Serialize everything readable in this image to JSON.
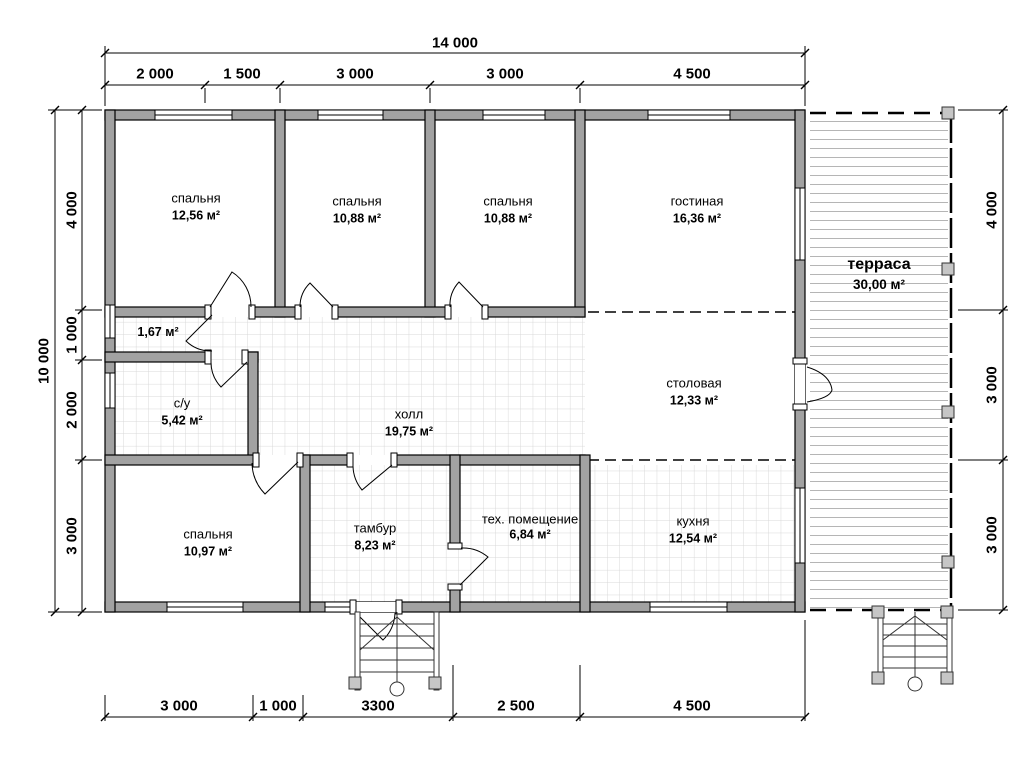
{
  "title": "План дома 14000 x 10000",
  "rooms": [
    {
      "name": "спальня",
      "area": "12,56 м²"
    },
    {
      "name": "спальня",
      "area": "10,88 м²"
    },
    {
      "name": "спальня",
      "area": "10,88 м²"
    },
    {
      "name": "гостиная",
      "area": "16,36 м²"
    },
    {
      "name": "терраса",
      "area": "30,00 м²"
    },
    {
      "name": "",
      "area": "1,67 м²"
    },
    {
      "name": "с/у",
      "area": "5,42 м²"
    },
    {
      "name": "холл",
      "area": "19,75 м²"
    },
    {
      "name": "столовая",
      "area": "12,33 м²"
    },
    {
      "name": "спальня",
      "area": "10,97 м²"
    },
    {
      "name": "тамбур",
      "area": "8,23 м²"
    },
    {
      "name": "тех. помещение",
      "area": "6,84 м²"
    },
    {
      "name": "кухня",
      "area": "12,54 м²"
    }
  ],
  "dimensions": {
    "top_total": "14 000",
    "top": [
      "2 000",
      "1 500",
      "3 000",
      "3 000",
      "4 500"
    ],
    "left_total": "10 000",
    "left": [
      "4 000",
      "1 000",
      "2 000",
      "3 000"
    ],
    "right": [
      "4 000",
      "3 000",
      "3 000"
    ],
    "bottom": [
      "3 000",
      "1 000",
      "3300",
      "2 500",
      "4 500"
    ]
  },
  "colors": {
    "wall_fill": "#a2a2a2",
    "line": "#000000",
    "tile_grid": "#d8d8d8",
    "deck_line": "#b5b5b5",
    "post_fill": "#c6c6c6"
  }
}
